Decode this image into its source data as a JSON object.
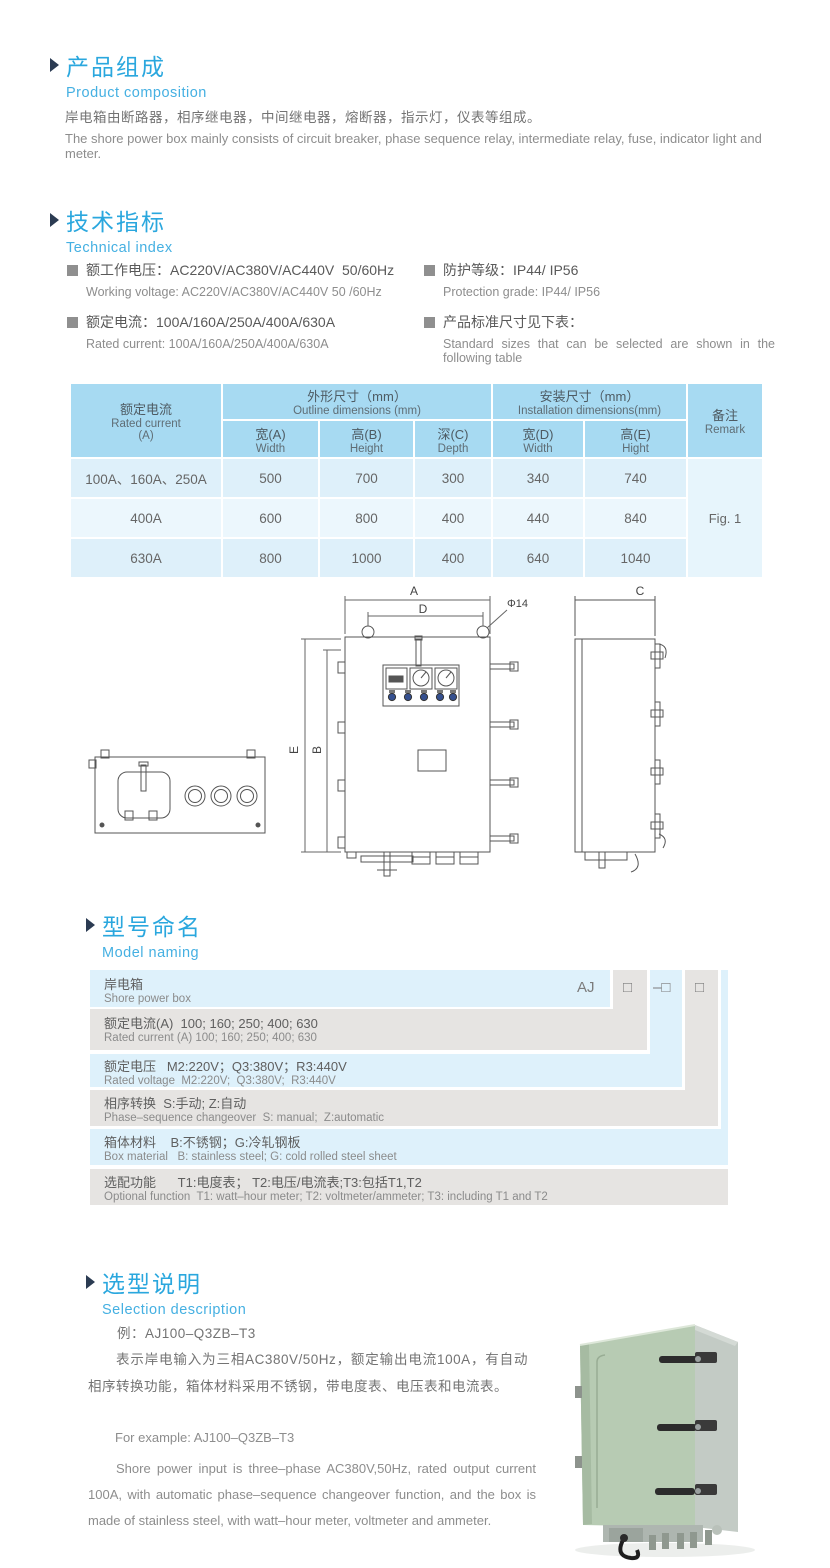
{
  "colors": {
    "accent_blue": "#2aa7de",
    "subtitle_blue": "#45b0e2",
    "table_header_bg": "#a7daf2",
    "table_row_light": "#ecf7fd",
    "table_row_dark": "#def0fa",
    "stair_row_blue": "#def1fb",
    "stair_row_gray": "#e6e4e2",
    "cabinet_green": "#b7cbb3"
  },
  "section_composition": {
    "title_cn": "产品组成",
    "title_en": "Product  composition",
    "body_cn": "岸电箱由断路器，相序继电器，中间继电器，熔断器，指示灯，仪表等组成。",
    "body_en": "The shore power box mainly consists of circuit breaker, phase sequence relay, intermediate relay, fuse, indicator light and meter."
  },
  "section_technical": {
    "title_cn": "技术指标",
    "title_en": "Technical index",
    "bullets_left": [
      {
        "cn": "额工作电压：AC220V/AC380V/AC440V  50/60Hz",
        "en": "Working voltage: AC220V/AC380V/AC440V 50 /60Hz"
      },
      {
        "cn": "额定电流：100A/160A/250A/400A/630A",
        "en": "Rated current: 100A/160A/250A/400A/630A"
      }
    ],
    "bullets_right": [
      {
        "cn": "防护等级：IP44/ IP56",
        "en": "Protection grade: IP44/ IP56"
      },
      {
        "cn": "产品标准尺寸见下表：",
        "en": "Standard  sizes  that  can  be  selected  are  shown  in  the following table"
      }
    ]
  },
  "dimensions_table": {
    "col1": {
      "cn": "额定电流",
      "en": "Rated current",
      "unit": "(A)"
    },
    "outline": {
      "cn": "外形尺寸（mm）",
      "en": "Outline dimensions (mm)"
    },
    "install": {
      "cn": "安装尺寸（mm）",
      "en": "Installation dimensions(mm)"
    },
    "remark": {
      "cn": "备注",
      "en": "Remark"
    },
    "sub_headers": [
      {
        "cn": "宽(A)",
        "en": "Width"
      },
      {
        "cn": "高(B)",
        "en": "Height"
      },
      {
        "cn": "深(C)",
        "en": "Depth"
      },
      {
        "cn": "宽(D)",
        "en": "Width"
      },
      {
        "cn": "高(E)",
        "en": "Hight"
      }
    ],
    "rows": [
      {
        "current": "100A、160A、250A",
        "values": [
          "500",
          "700",
          "300",
          "340",
          "740"
        ]
      },
      {
        "current": "400A",
        "values": [
          "600",
          "800",
          "400",
          "440",
          "840"
        ]
      },
      {
        "current": "630A",
        "values": [
          "800",
          "1000",
          "400",
          "640",
          "1040"
        ]
      }
    ],
    "remark_value": "Fig. 1"
  },
  "drawing": {
    "labels": {
      "a": "A",
      "d": "D",
      "dia": "Φ14",
      "b": "B",
      "e": "E",
      "c": "C"
    }
  },
  "section_model": {
    "title_cn": "型号命名",
    "title_en": "Model naming",
    "codes": {
      "prefix": "AJ",
      "box1": "□",
      "box2": "–□",
      "box3": "□"
    },
    "rows": [
      {
        "cn": "岸电箱",
        "en": "Shore power box"
      },
      {
        "cn": "额定电流(A)  100; 160; 250; 400; 630",
        "en": "Rated current (A) 100; 160; 250; 400; 630"
      },
      {
        "cn": "额定电压   M2:220V；Q3:380V；R3:440V",
        "en": "Rated voltage  M2:220V;  Q3:380V;  R3:440V"
      },
      {
        "cn": "相序转换  S:手动; Z:自动",
        "en": "Phase–sequence changeover  S: manual;  Z:automatic"
      },
      {
        "cn": "箱体材料    B:不锈钢；G:冷轧钢板",
        "en": "Box material   B: stainless steel; G: cold rolled steel sheet"
      },
      {
        "cn": "选配功能      T1:电度表； T2:电压/电流表;T3:包括T1,T2",
        "en": "Optional function  T1: watt–hour meter; T2: voltmeter/ammeter; T3: including T1 and T2"
      }
    ]
  },
  "section_selection": {
    "title_cn": "选型说明",
    "title_en": "Selection description",
    "example_cn": "例：AJ100–Q3ZB–T3",
    "body_cn": "表示岸电输入为三相AC380V/50Hz，额定输出电流100A，有自动相序转换功能，箱体材料采用不锈钢，带电度表、电压表和电流表。",
    "example_en": "For example: AJ100–Q3ZB–T3",
    "body_en": "Shore power input is three–phase AC380V,50Hz, rated output current 100A, with automatic phase–sequence changeover function, and the box is made of stainless steel, with watt–hour meter, voltmeter and ammeter."
  }
}
